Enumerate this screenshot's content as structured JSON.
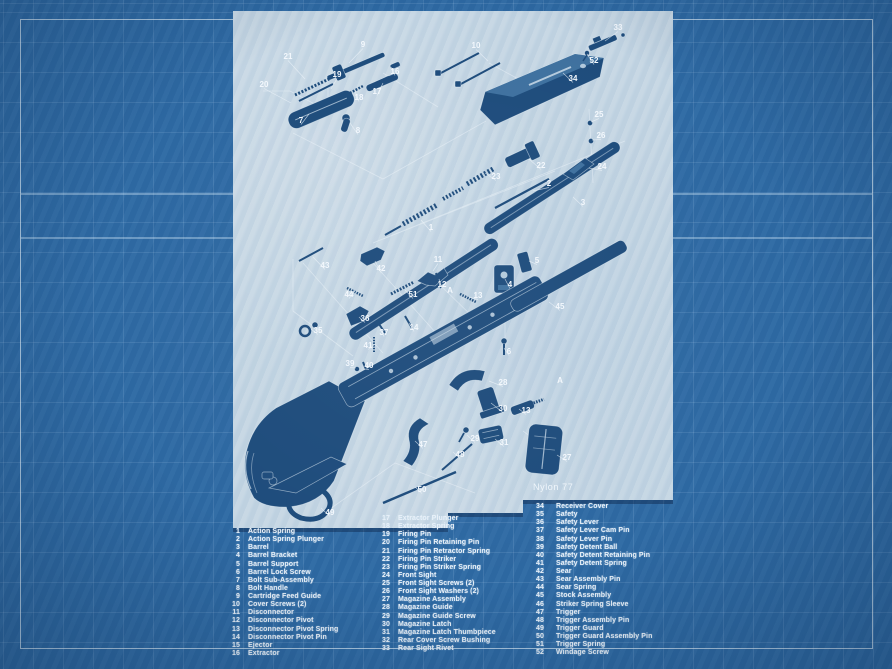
{
  "colors": {
    "background_blue": "#2e6aa4",
    "grid_line": "#c3def5",
    "frame_line": "#e6f2fb",
    "paper": "#c2d4e2",
    "part_ink": "#1e4c7c",
    "label_white": "#f3f8fd",
    "list_text": "#e9f1f9"
  },
  "diagram": {
    "title": "Nylon 77",
    "labels": [
      {
        "t": "9",
        "x": 130,
        "y": 36,
        "l": [
          116,
          52
        ]
      },
      {
        "t": "21",
        "x": 55,
        "y": 48,
        "l": [
          72,
          68
        ]
      },
      {
        "t": "19",
        "x": 104,
        "y": 66,
        "l": [
          98,
          78
        ]
      },
      {
        "t": "20",
        "x": 31,
        "y": 76,
        "l": [
          58,
          92
        ]
      },
      {
        "t": "16",
        "x": 162,
        "y": 63,
        "l": [
          158,
          56
        ]
      },
      {
        "t": "17",
        "x": 144,
        "y": 83,
        "l": [
          150,
          72
        ]
      },
      {
        "t": "18",
        "x": 126,
        "y": 89,
        "l": [
          122,
          80
        ]
      },
      {
        "t": "7",
        "x": 68,
        "y": 112,
        "l": [
          76,
          103
        ]
      },
      {
        "t": "8",
        "x": 125,
        "y": 122,
        "l": [
          117,
          112
        ]
      },
      {
        "t": "10",
        "x": 243,
        "y": 37,
        "l": [
          255,
          50
        ]
      },
      {
        "t": "33",
        "x": 385,
        "y": 19,
        "l": [
          372,
          30
        ]
      },
      {
        "t": "52",
        "x": 361,
        "y": 52,
        "l": [
          354,
          43
        ]
      },
      {
        "t": "34",
        "x": 340,
        "y": 70,
        "l": [
          330,
          62
        ]
      },
      {
        "t": "25",
        "x": 366,
        "y": 106,
        "l": [
          358,
          111
        ]
      },
      {
        "t": "26",
        "x": 368,
        "y": 127,
        "l": [
          359,
          129
        ]
      },
      {
        "t": "24",
        "x": 369,
        "y": 158,
        "l": [
          356,
          157
        ]
      },
      {
        "t": "22",
        "x": 308,
        "y": 157,
        "l": [
          296,
          148
        ]
      },
      {
        "t": "23",
        "x": 263,
        "y": 168,
        "l": [
          252,
          162
        ]
      },
      {
        "t": "2",
        "x": 316,
        "y": 175,
        "l": [
          300,
          180
        ]
      },
      {
        "t": "1",
        "x": 198,
        "y": 219,
        "l": [
          188,
          209
        ]
      },
      {
        "t": "3",
        "x": 350,
        "y": 194,
        "l": [
          340,
          186
        ]
      },
      {
        "t": "5",
        "x": 304,
        "y": 252,
        "l": [
          296,
          250
        ]
      },
      {
        "t": "4",
        "x": 277,
        "y": 276,
        "l": [
          272,
          268
        ]
      },
      {
        "t": "13",
        "x": 245,
        "y": 287,
        "l": [
          236,
          286
        ]
      },
      {
        "t": "12",
        "x": 209,
        "y": 276,
        "l": [
          206,
          268
        ]
      },
      {
        "t": "11",
        "x": 205,
        "y": 251,
        "l": [
          200,
          260
        ]
      },
      {
        "t": "42",
        "x": 148,
        "y": 260,
        "l": [
          142,
          250
        ]
      },
      {
        "t": "43",
        "x": 92,
        "y": 257,
        "l": [
          80,
          246
        ]
      },
      {
        "t": "44",
        "x": 116,
        "y": 286,
        "l": [
          122,
          280
        ]
      },
      {
        "t": "51",
        "x": 180,
        "y": 286,
        "l": [
          172,
          279
        ]
      },
      {
        "t": "35",
        "x": 85,
        "y": 322,
        "l": [
          78,
          318
        ]
      },
      {
        "t": "36",
        "x": 132,
        "y": 310,
        "l": [
          126,
          306
        ]
      },
      {
        "t": "37",
        "x": 151,
        "y": 324,
        "l": [
          148,
          318
        ]
      },
      {
        "t": "14",
        "x": 181,
        "y": 319,
        "l": [
          176,
          312
        ]
      },
      {
        "t": "41",
        "x": 135,
        "y": 337,
        "l": [
          141,
          334
        ]
      },
      {
        "t": "39",
        "x": 117,
        "y": 355,
        "l": [
          123,
          357
        ]
      },
      {
        "t": "40",
        "x": 136,
        "y": 357,
        "l": [
          131,
          358
        ]
      },
      {
        "t": "6",
        "x": 276,
        "y": 343,
        "l": [
          271,
          337
        ]
      },
      {
        "t": "45",
        "x": 327,
        "y": 298,
        "l": [
          316,
          291
        ]
      },
      {
        "t": "28",
        "x": 270,
        "y": 374,
        "l": [
          256,
          370
        ]
      },
      {
        "t": "30",
        "x": 270,
        "y": 400,
        "l": [
          258,
          392
        ]
      },
      {
        "t": "13",
        "x": 293,
        "y": 402,
        "l": [
          286,
          398
        ]
      },
      {
        "t": "29",
        "x": 242,
        "y": 430,
        "l": [
          234,
          424
        ]
      },
      {
        "t": "31",
        "x": 271,
        "y": 434,
        "l": [
          262,
          428
        ]
      },
      {
        "t": "27",
        "x": 334,
        "y": 449,
        "l": [
          324,
          444
        ]
      },
      {
        "t": "47",
        "x": 190,
        "y": 436,
        "l": [
          182,
          430
        ]
      },
      {
        "t": "48",
        "x": 227,
        "y": 446,
        "l": [
          220,
          441
        ]
      },
      {
        "t": "50",
        "x": 189,
        "y": 481,
        "l": [
          182,
          476
        ]
      },
      {
        "t": "49",
        "x": 97,
        "y": 504,
        "l": [
          88,
          497
        ]
      },
      {
        "t": "A",
        "x": 217,
        "y": 282
      },
      {
        "t": "A",
        "x": 327,
        "y": 372
      }
    ]
  },
  "parts_list": {
    "columns": [
      [
        {
          "num": "1",
          "name": "Action Spring"
        },
        {
          "num": "2",
          "name": "Action Spring Plunger"
        },
        {
          "num": "3",
          "name": "Barrel"
        },
        {
          "num": "4",
          "name": "Barrel Bracket"
        },
        {
          "num": "5",
          "name": "Barrel Support"
        },
        {
          "num": "6",
          "name": "Barrel Lock Screw"
        },
        {
          "num": "7",
          "name": "Bolt Sub-Assembly"
        },
        {
          "num": "8",
          "name": "Bolt Handle"
        },
        {
          "num": "9",
          "name": "Cartridge Feed Guide"
        },
        {
          "num": "10",
          "name": "Cover Screws (2)"
        },
        {
          "num": "11",
          "name": "Disconnector"
        },
        {
          "num": "12",
          "name": "Disconnector Pivot"
        },
        {
          "num": "13",
          "name": "Disconnector Pivot Spring"
        },
        {
          "num": "14",
          "name": "Disconnector Pivot Pin"
        },
        {
          "num": "15",
          "name": "Ejector"
        },
        {
          "num": "16",
          "name": "Extractor"
        }
      ],
      [
        {
          "num": "17",
          "name": "Extractor Plunger"
        },
        {
          "num": "18",
          "name": "Extractor Spring"
        },
        {
          "num": "19",
          "name": "Firing Pin"
        },
        {
          "num": "20",
          "name": "Firing Pin Retaining Pin"
        },
        {
          "num": "21",
          "name": "Firing Pin Retractor Spring"
        },
        {
          "num": "22",
          "name": "Firing Pin Striker"
        },
        {
          "num": "23",
          "name": "Firing Pin Striker Spring"
        },
        {
          "num": "24",
          "name": "Front Sight"
        },
        {
          "num": "25",
          "name": "Front Sight Screws (2)"
        },
        {
          "num": "26",
          "name": "Front Sight Washers (2)"
        },
        {
          "num": "27",
          "name": "Magazine Assembly"
        },
        {
          "num": "28",
          "name": "Magazine Guide"
        },
        {
          "num": "29",
          "name": "Magazine Guide Screw"
        },
        {
          "num": "30",
          "name": "Magazine Latch"
        },
        {
          "num": "31",
          "name": "Magazine Latch Thumbpiece"
        },
        {
          "num": "32",
          "name": "Rear Cover Screw Bushing"
        },
        {
          "num": "33",
          "name": "Rear Sight Rivet"
        }
      ],
      [
        {
          "num": "34",
          "name": "Receiver Cover"
        },
        {
          "num": "35",
          "name": "Safety"
        },
        {
          "num": "36",
          "name": "Safety Lever"
        },
        {
          "num": "37",
          "name": "Safety Lever Cam Pin"
        },
        {
          "num": "38",
          "name": "Safety Lever Pin"
        },
        {
          "num": "39",
          "name": "Safety Detent Ball"
        },
        {
          "num": "40",
          "name": "Safety Detent Retaining Pin"
        },
        {
          "num": "41",
          "name": "Safety Detent Spring"
        },
        {
          "num": "42",
          "name": "Sear"
        },
        {
          "num": "43",
          "name": "Sear Assembly Pin"
        },
        {
          "num": "44",
          "name": "Sear Spring"
        },
        {
          "num": "45",
          "name": "Stock Assembly"
        },
        {
          "num": "46",
          "name": "Striker Spring Sleeve"
        },
        {
          "num": "47",
          "name": "Trigger"
        },
        {
          "num": "48",
          "name": "Trigger Assembly Pin"
        },
        {
          "num": "49",
          "name": "Trigger Guard"
        },
        {
          "num": "50",
          "name": "Trigger Guard Assembly Pin"
        },
        {
          "num": "51",
          "name": "Trigger Spring"
        },
        {
          "num": "52",
          "name": "Windage Screw"
        }
      ]
    ]
  }
}
